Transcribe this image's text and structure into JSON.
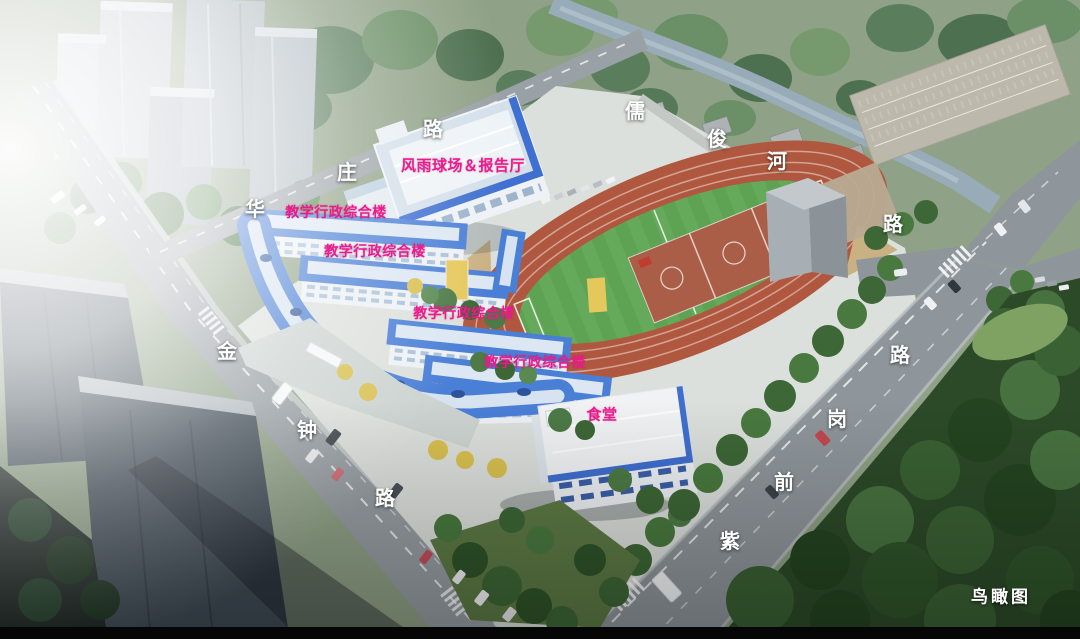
{
  "view_label": "鸟瞰图",
  "annotation_colors": {
    "building_label": "#ec1a8c",
    "road_label": "#ffffff"
  },
  "building_labels": {
    "gym": "风雨球场＆报告厅",
    "teaching": [
      "教学行政综合楼",
      "教学行政综合楼",
      "教学行政综合楼",
      "教学行政综合楼"
    ],
    "canteen": "食堂"
  },
  "road_labels": {
    "north_road": [
      "华",
      "庄",
      "路"
    ],
    "west_road": [
      "金",
      "钟",
      "路"
    ],
    "river": [
      "儒",
      "俊",
      "河"
    ],
    "east_road": [
      "紫",
      "前",
      "岗",
      "路",
      "路"
    ]
  },
  "scene_colors": {
    "roof_blue": "#4a7fd6",
    "track_red": "#b0583f",
    "field_green": "#5ea254",
    "road_gray": "#969da2"
  }
}
